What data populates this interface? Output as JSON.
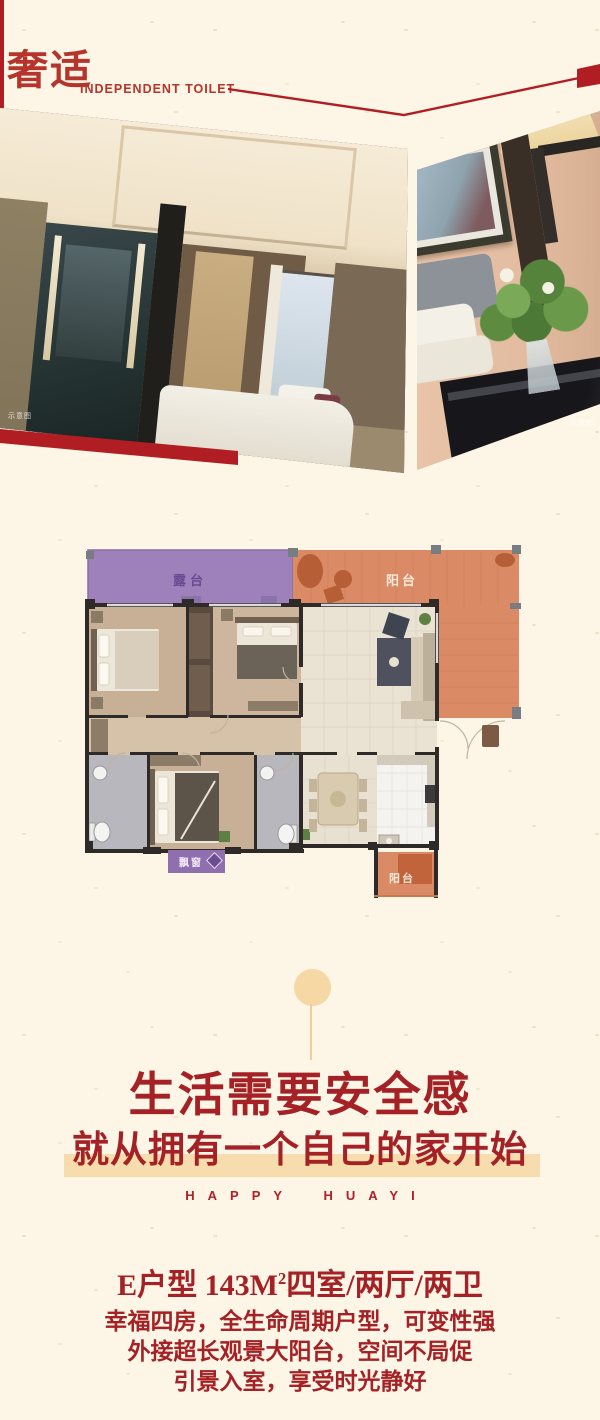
{
  "colors": {
    "background_cream": "#fdf5e6",
    "accent_red": "#b01e24",
    "text_red": "#a42125",
    "band_tan": "#f7dcae",
    "ornament_tan": "#f5d8a3",
    "terrace_purple": "#9e80bb",
    "balcony_orange": "#db8a66"
  },
  "header": {
    "brand_cn": "奢适",
    "brand_en": "INDEPENDENT TOILET"
  },
  "photos": {
    "left_watermark": "示意图",
    "right_watermark": "示意图"
  },
  "floorplan": {
    "terrace_label": "露台",
    "balcony_label": "阳台",
    "bay_window_label": "飘窗",
    "lower_balcony_label": "阳台"
  },
  "slogan": {
    "line1": "生活需要安全感",
    "line2": "就从拥有一个自己的家开始",
    "tagline": "HAPPY HUAYI"
  },
  "details": {
    "headline_prefix": "E户型 143M",
    "headline_sup": "2",
    "headline_suffix": "四室/两厅/两卫",
    "line2": "幸福四房，全生命周期户型，可变性强",
    "line3": "外接超长观景大阳台，空间不局促",
    "line4": "引景入室，享受时光静好"
  }
}
